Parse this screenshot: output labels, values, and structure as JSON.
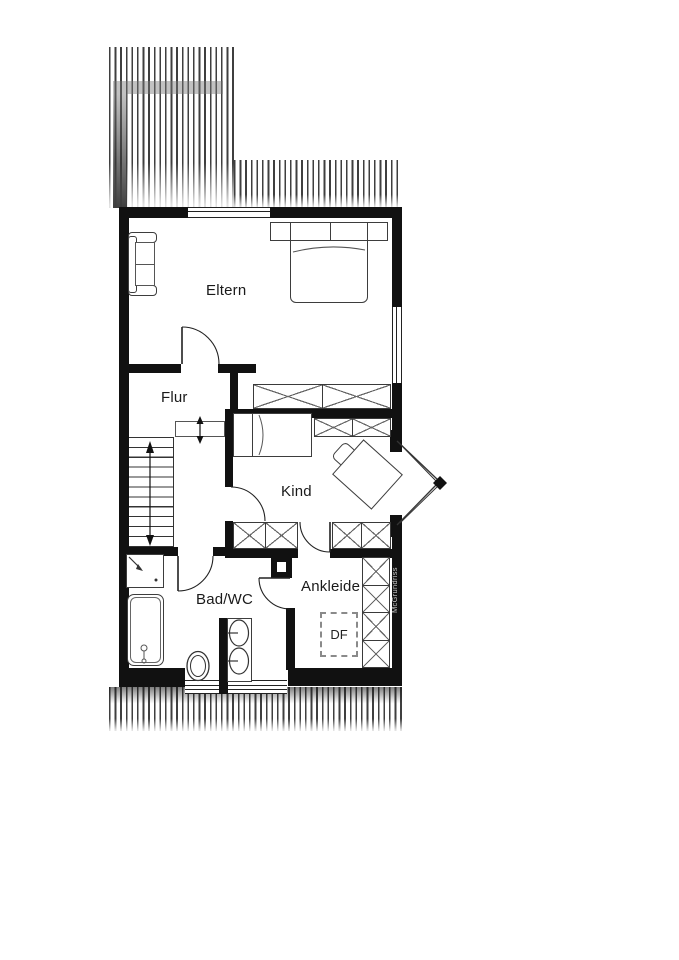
{
  "plan": {
    "labels": {
      "eltern": "Eltern",
      "flur": "Flur",
      "kind": "Kind",
      "bad": "Bad/WC",
      "ankleide": "Ankleide",
      "roof_window": "DF",
      "watermark": "McGrundriss"
    },
    "colors": {
      "wall": "#111111",
      "hatch_line": "#3f3f3f",
      "furniture_line": "#3d3d3d",
      "label_text": "#1a1a1a",
      "watermark_text": "#c9c9c9",
      "background": "#ffffff"
    }
  }
}
